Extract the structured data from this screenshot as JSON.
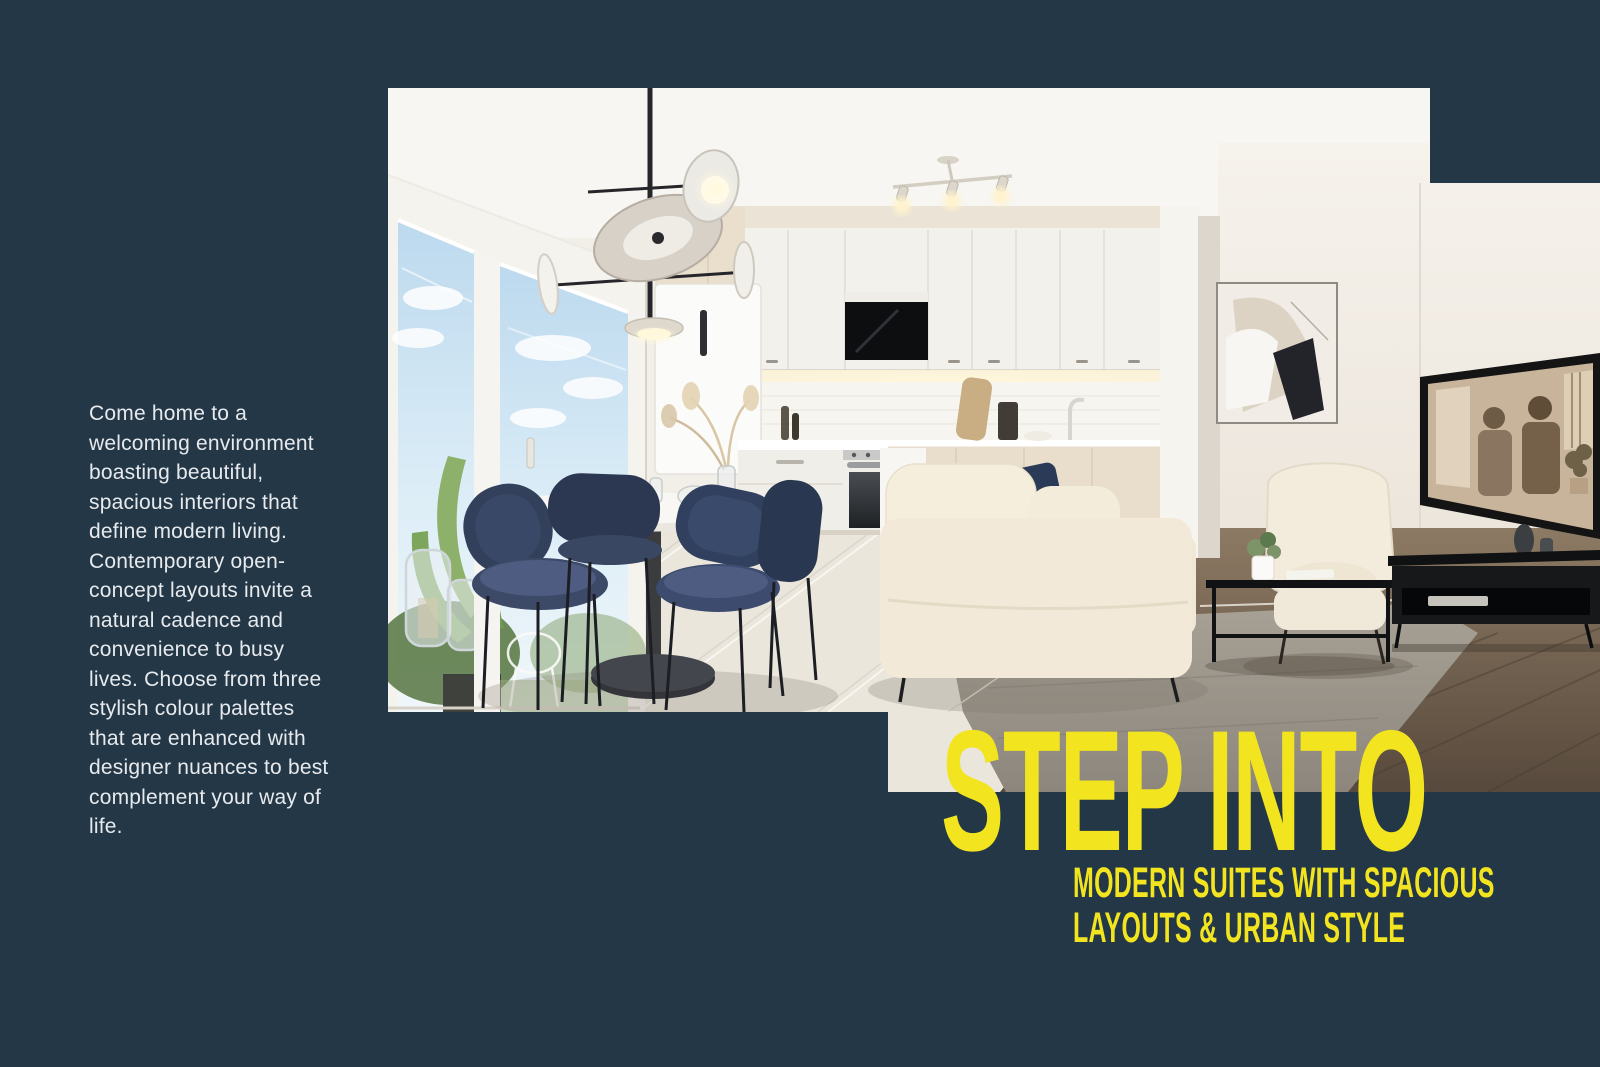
{
  "page": {
    "background_color": "#233747",
    "accent_yellow": "#F2E41F",
    "body_text_color": "#E7EAED"
  },
  "intro": {
    "text": "Come home to a welcoming environment boasting beautiful, spacious interiors that define modern living. Contemporary open-concept layouts invite a natural cadence and convenience to busy lives. Choose from three stylish colour palettes that are enhanced with designer nuances to best complement your way of life."
  },
  "hero": {
    "headline": "STEP INTO",
    "subheadline": [
      "MODERN SUITES WITH SPACIOUS",
      "LAYOUTS & URBAN STYLE"
    ]
  },
  "photo": {
    "description": "Open-concept suite interior: white kitchen with under-cabinet lighting, round dining table with navy velvet chairs beside a bright window with palm plant, cream sofa and wing chair, black coffee table and media console, wall-mounted TV playing a black-and-white film, abstract art on the wall"
  }
}
